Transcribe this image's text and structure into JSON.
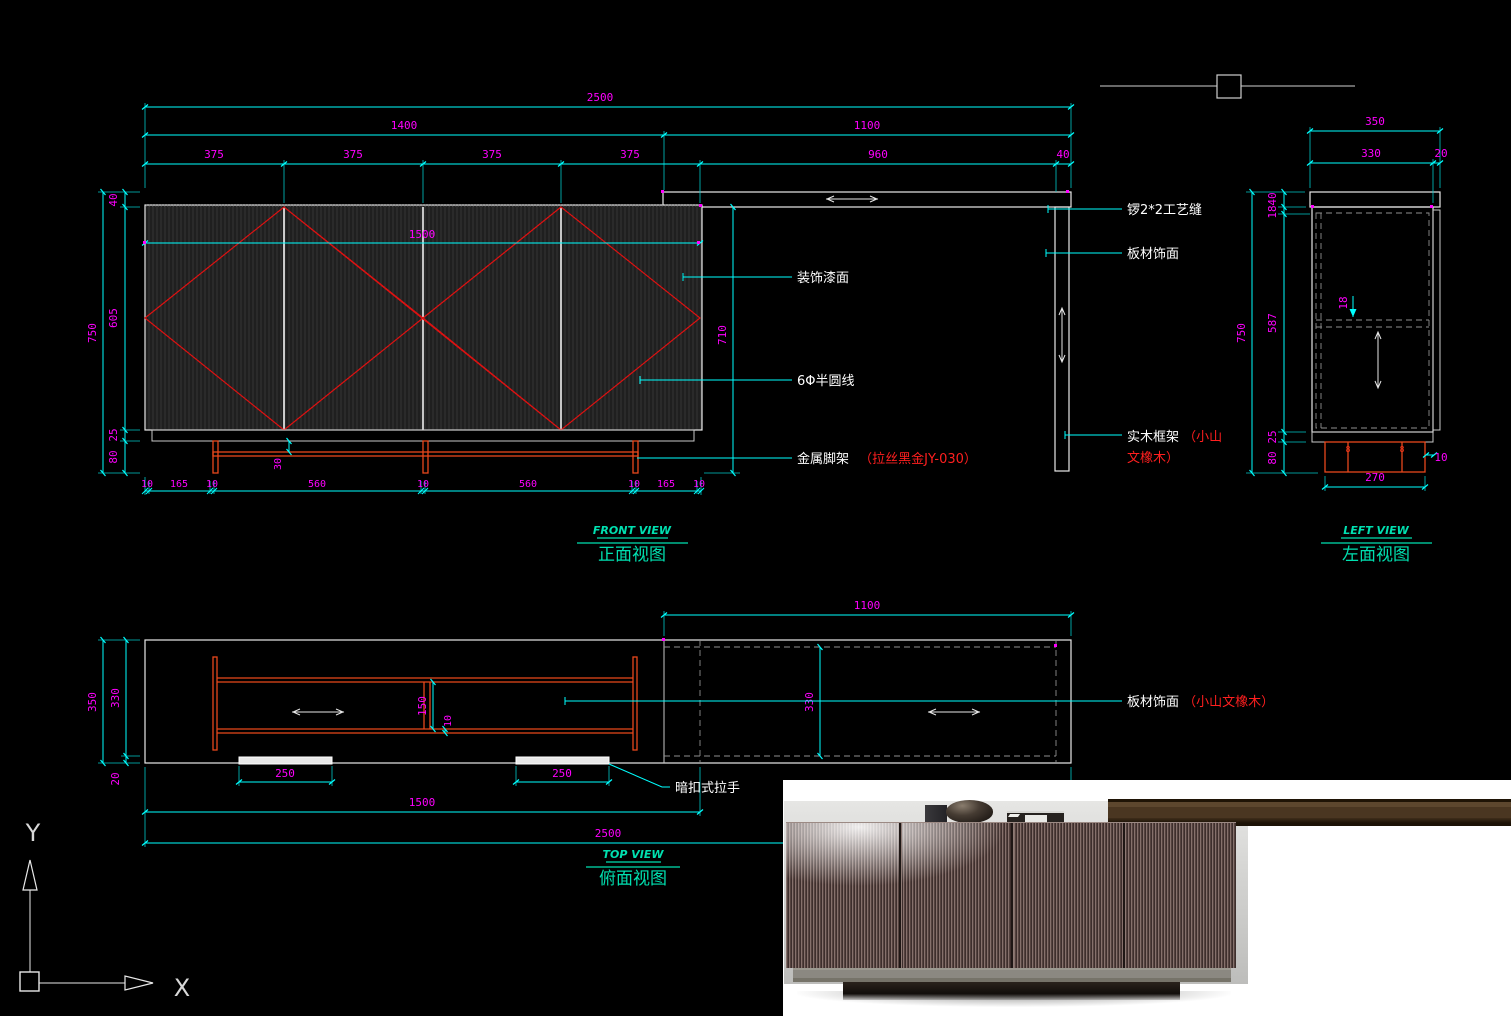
{
  "colors": {
    "background": "#000000",
    "dimension_line": "#00ffff",
    "dimension_text": "#ff00ff",
    "outline": "#e8e8e8",
    "hatch_red": "#dd1111",
    "leg_red": "#e8481b",
    "label_text": "#ffffff",
    "label_note_red": "#ff1f1f",
    "title_teal": "#00e0b0"
  },
  "views": {
    "front": {
      "title_en": "FRONT VIEW",
      "title_cn": "正面视图",
      "dims": {
        "total": "2500",
        "left_sec": "1400",
        "right_sec": "1100",
        "door": "375",
        "counter": "960",
        "edge": "40",
        "height": "750",
        "top_t": "40",
        "door_h": "605",
        "plinth_h": "25",
        "leg_h": "80",
        "doors_w": "1500",
        "under_h": "710",
        "leg_set": "30",
        "bottom": [
          "10",
          "165",
          "10",
          "560",
          "10",
          "560",
          "10",
          "165",
          "10"
        ]
      },
      "labels": {
        "paint": "装饰漆面",
        "bead": "6Φ半圆线",
        "leg": "金属脚架",
        "leg_note": "（拉丝黑金JY-030）",
        "groove": "锣2*2工艺缝",
        "panel": "板材饰面",
        "frame": "实木框架",
        "frame_note1": "（小山",
        "frame_note2": "文橡木）"
      }
    },
    "left": {
      "title_en": "LEFT VIEW",
      "title_cn": "左面视图",
      "dims": {
        "width": "350",
        "body": "330",
        "back": "20",
        "height": "750",
        "top_t": "40",
        "top_gap": "18",
        "door_h": "587",
        "plinth_h": "25",
        "leg_h": "80",
        "shelf_t": "18",
        "leg_w": "270",
        "leg_in": "10",
        "leg_mark": "8"
      }
    },
    "top": {
      "title_en": "TOP VIEW",
      "title_cn": "俯面视图",
      "dims": {
        "right_sec": "1100",
        "depth": "350",
        "body": "330",
        "back": "20",
        "rail_gap": "150",
        "rail_t": "10",
        "right_depth": "330",
        "handle": "250",
        "doors_w": "1500",
        "total": "2500"
      },
      "labels": {
        "handle": "暗扣式拉手",
        "veneer": "板材饰面",
        "veneer_note": "（小山文橡木）"
      }
    },
    "axes": {
      "x": "X",
      "y": "Y"
    }
  }
}
